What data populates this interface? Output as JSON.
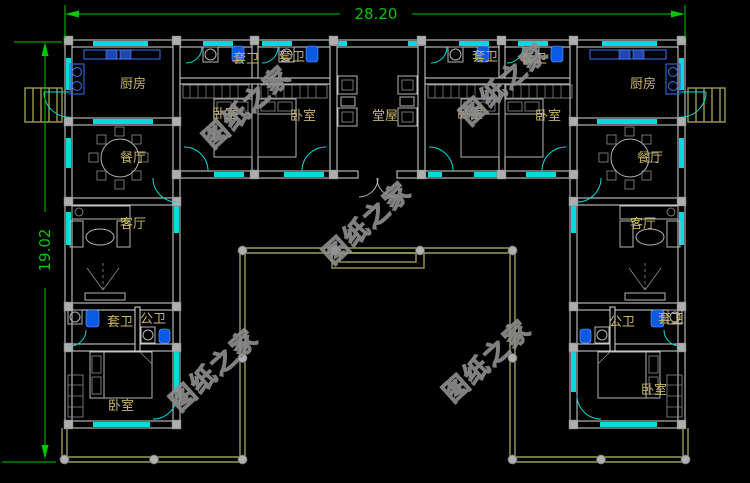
{
  "drawing": {
    "title": "U-shaped courtyard house floor plan",
    "dimensions": {
      "width_label": "28.20",
      "height_label": "19.02"
    },
    "watermark": "图纸之家",
    "rooms": {
      "kitchen": "厨房",
      "dining": "餐厅",
      "living": "客厅",
      "bedroom": "卧室",
      "hall": "堂屋",
      "ensuite_bath": "套卫",
      "public_bath": "公卫"
    },
    "colors": {
      "background": "#000000",
      "wall": "#d9d9d9",
      "window": "#00dcdc",
      "label": "#c8b46a",
      "dimension": "#00c800",
      "fence": "#9c9c52",
      "column": "#aeaeae",
      "fixture_blue": "#0a5ae6",
      "counter_blue": "#2f5fd0",
      "watermark_gray": "#8e8e8e"
    }
  }
}
